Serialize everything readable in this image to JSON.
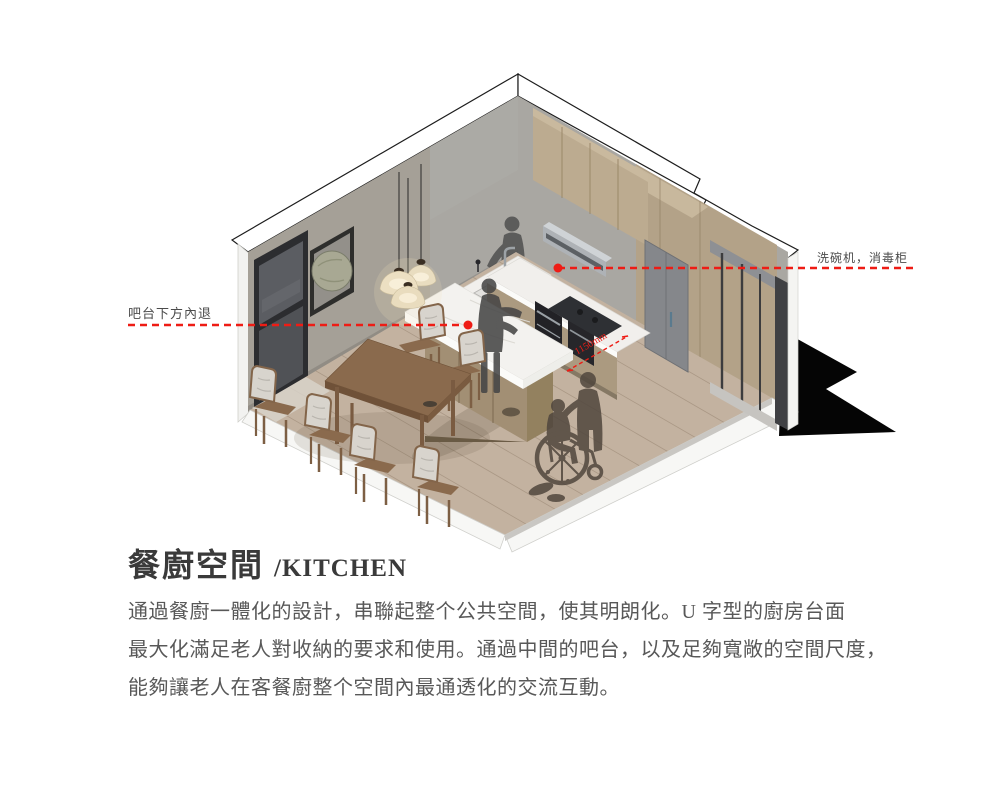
{
  "title": {
    "zh": "餐廚空間",
    "en": "/KITCHEN"
  },
  "paragraph": {
    "line1": "通過餐廚一體化的設計，串聯起整个公共空間，使其明朗化。U 字型的廚房台面",
    "line2": "最大化滿足老人對收納的要求和使用。通過中間的吧台，以及足夠寬敞的空間尺度，",
    "line3": "能夠讓老人在客餐廚整个空間內最通透化的交流互動。"
  },
  "callouts": {
    "bar_recess": "吧台下方內退",
    "appliances": "洗碗机，消毒柜",
    "dimension": "1150mm"
  },
  "colors": {
    "annotation_red": "#ee1c15",
    "title_text": "#3a3a3a",
    "body_text": "#585858",
    "concrete_wall": "#a9a7a2",
    "plaster_wall": "#a5a097",
    "wood_cabinet": "#b3a288",
    "wood_floor": "#c3b2a0",
    "marble_counter": "#f1efec",
    "table_wood": "#8a6a4d",
    "door_glass": "#5c5e63",
    "pocket_door_gray": "#85878b",
    "silhouette_gray": "#4a4a4a",
    "shadow_black": "#000000"
  },
  "scene": {
    "kind": "isometric cutaway rendering",
    "room": "kitchen and dining room with U-shaped counter, bar island, dining table, wheelchair user shadow"
  }
}
